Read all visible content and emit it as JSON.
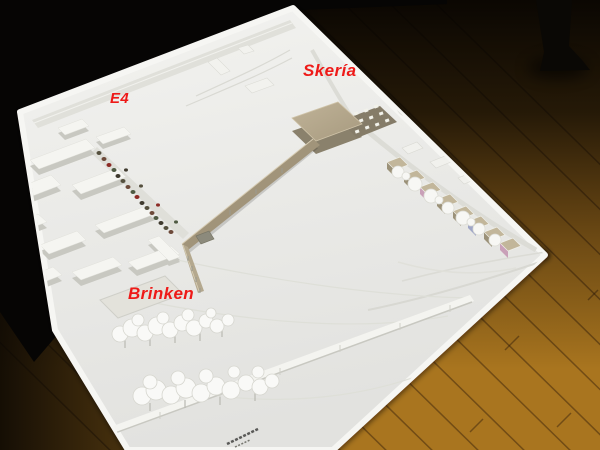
{
  "scene": {
    "description": "Photograph of a white architectural site model on a table over a wooden floor, with red place-name annotations",
    "annotations": [
      {
        "id": "skeria",
        "label": "Skería"
      },
      {
        "id": "e4",
        "label": "E4"
      },
      {
        "id": "brinken",
        "label": "Brinken"
      }
    ]
  },
  "colors": {
    "annotation_red": "#ee1a18",
    "model_white": "#e9e9e6",
    "model_rim": "#f4f4f1",
    "proposal_building_gray": "#b2a58a",
    "bridge_ramp_gray": "#a1947a",
    "house_tan": "#9b9178",
    "floor_wood": "#a9751f",
    "background_black": "#070605"
  }
}
